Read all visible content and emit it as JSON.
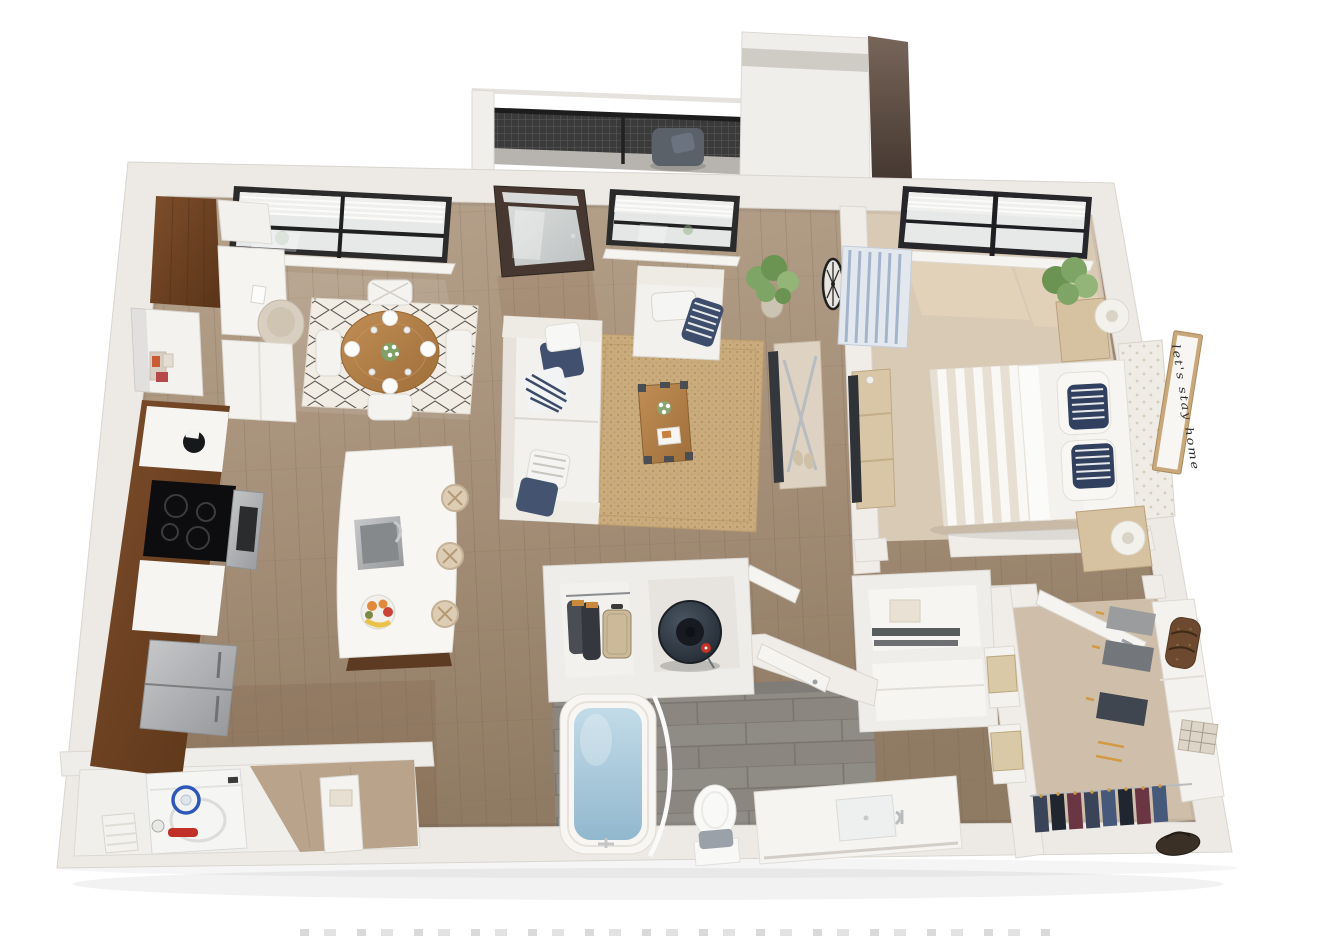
{
  "scene": {
    "type": "3d-floor-plan-rendering",
    "title": "one-bedroom apartment 3D floor plan",
    "wall_art_text": "let's stay home",
    "rooms": [
      {
        "name": "balcony",
        "floor": "concrete",
        "items": [
          "mesh-railing",
          "lounge-chair",
          "throw-pillow"
        ]
      },
      {
        "name": "entry",
        "floor": "hardwood",
        "items": [
          "glass-entry-door",
          "transom-window",
          "door-handle"
        ]
      },
      {
        "name": "kitchen",
        "floor": "hardwood",
        "items": [
          "walnut-pantry",
          "walnut-base-cabinets",
          "white-counter",
          "stand-mixer",
          "glass-cooktop",
          "stainless-wall-oven",
          "stainless-refrigerator",
          "built-in-desk",
          "office-chair",
          "upper-cabinet",
          "display-niche",
          "storage-boxes",
          "kitchen-island",
          "undermount-sink",
          "chrome-faucet",
          "fruit-bowl",
          "bar-stool",
          "bar-stool",
          "bar-stool"
        ]
      },
      {
        "name": "dining-area",
        "floor": "hardwood",
        "items": [
          "round-oak-table",
          "cross-back-chair",
          "cross-back-chair",
          "cross-back-chair",
          "cross-back-chair",
          "diamond-pattern-rug",
          "place-setting",
          "place-setting",
          "place-setting",
          "place-setting",
          "flower-centerpiece",
          "double-window"
        ]
      },
      {
        "name": "living-room",
        "floor": "hardwood",
        "items": [
          "white-sofa",
          "navy-pillow",
          "striped-pillow",
          "white-armchair",
          "jute-rug",
          "trunk-coffee-table",
          "flower-vase",
          "magazine",
          "media-console",
          "flat-screen-tv",
          "potted-plant",
          "wall-clock",
          "slippers",
          "window"
        ]
      },
      {
        "name": "bedroom",
        "floor": "carpet",
        "items": [
          "upholstered-bed",
          "tufted-headboard",
          "striped-duvet",
          "white-pillows",
          "navy-striped-pillow",
          "navy-striped-pillow",
          "nightstand",
          "nightstand",
          "drum-lamp",
          "drum-lamp",
          "striped-accent-chair",
          "dresser-console",
          "flat-screen-tv",
          "potted-plant",
          "wall-art-sign",
          "double-window"
        ]
      },
      {
        "name": "bathroom",
        "floor": "gray-tile",
        "items": [
          "soaking-tub",
          "curved-shower-rod",
          "tub-faucet",
          "toilet",
          "bath-towel",
          "vanity-counter",
          "undermount-sink",
          "chrome-faucet",
          "open-door"
        ]
      },
      {
        "name": "utility-closet",
        "items": [
          "water-heater",
          "red-valve"
        ]
      },
      {
        "name": "coat-closet",
        "items": [
          "hanging-coats",
          "suitcase",
          "hanger-rod"
        ]
      },
      {
        "name": "linen-closet",
        "items": [
          "folded-towel",
          "dark-shelves",
          "lower-shelf"
        ]
      },
      {
        "name": "laundry-closet",
        "floor": "hardwood",
        "items": [
          "washing-machine",
          "detergent-bottle",
          "red-handle",
          "storage-basket",
          "storage-cabinet",
          "towel"
        ]
      },
      {
        "name": "walk-in-closet",
        "floor": "carpet",
        "items": [
          "shelving-unit",
          "hanging-clothes",
          "wood-hangers",
          "duffel-bag",
          "plaid-blanket",
          "storage-box",
          "storage-box",
          "handbag",
          "clothes-rod",
          "open-door"
        ]
      }
    ],
    "palette": {
      "background": "#ffffff",
      "walls": "#edeae5",
      "wood_floor": "#ab9379",
      "carpet": "#d9cab6",
      "tile": "#8f8b85",
      "cabinet_walnut": "#6f4527",
      "counter_white": "#f6f5f2",
      "navy_accent": "#3e4d6b",
      "water_blue": "#a9c9dc",
      "plant_green": "#7fa566",
      "railing_black": "#2f2f2f",
      "oak": "#b8854f",
      "stainless": "#a9abad"
    }
  }
}
